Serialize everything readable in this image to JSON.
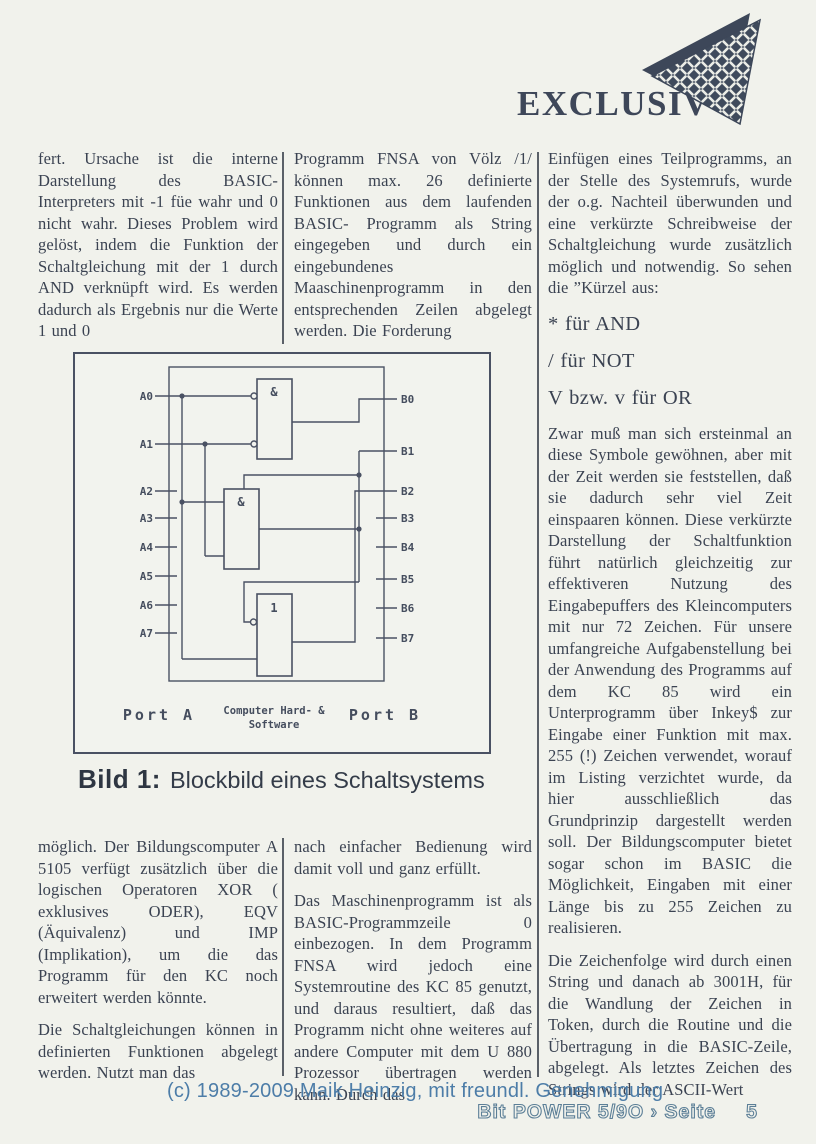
{
  "page": {
    "background": "#f1f2ec",
    "ink": "#3b4352"
  },
  "header": {
    "brand": "EXCLUSIV",
    "logo_icon": "woven-triangle"
  },
  "article": {
    "col1_top": {
      "p1": "fert. Ursache ist die interne Darstellung des BASIC- Interpreters mit -1 füe wahr und 0 nicht wahr. Dieses Problem wird gelöst, indem die Funktion der Schaltgleichung mit der 1 durch AND verknüpft wird. Es werden dadurch als Ergebnis nur die Werte 1 und 0"
    },
    "col2_top": {
      "p1": "Programm FNSA von Völz /1/ können max. 26 definierte Funktionen aus dem laufenden BASIC- Programm als String eingegeben und durch ein eingebundenes Maaschinenprogramm in den entsprechenden Zeilen abgelegt werden. Die Forderung"
    },
    "col3": {
      "p1": "Einfügen eines Teilprogramms, an der Stelle des Systemrufs, wurde der o.g. Nachteil überwunden und eine verkürzte Schreibweise der Schaltgleichung wurde zusätzlich möglich und notwendig. So sehen die ”Kürzel aus:",
      "shortcuts": [
        "* für AND",
        "/ für NOT",
        "V bzw. v für OR"
      ],
      "p2": "Zwar muß man sich ersteinmal an diese Symbole gewöhnen, aber mit der Zeit werden sie feststellen, daß sie dadurch sehr viel Zeit einspaaren können. Diese verkürzte Darstellung der Schaltfunktion führt natürlich gleichzeitig zur effektiveren Nutzung des Eingabepuffers des Kleincomputers mit nur 72 Zeichen. Für unsere umfangreiche Aufgabenstellung bei der Anwendung des Programms auf dem KC 85 wird ein Unterprogramm über Inkey$ zur Eingabe einer Funktion mit max. 255 (!) Zeichen verwendet, worauf im Listing verzichtet wurde, da hier ausschließlich das Grundprinzip dargestellt werden soll. Der Bildungscomputer bietet sogar schon im BASIC die Möglichkeit, Eingaben mit einer Länge bis zu 255 Zeichen zu realisieren.",
      "p3": "Die Zeichenfolge wird durch einen String und danach ab 3001H, für die Wandlung der Zeichen in Token, durch die Routine und die Übertragung in die BASIC-Zeile, abgelegt. Als letztes Zeichen des Strings wird der ASCII-Wert"
    },
    "col1_bottom": {
      "p1": "möglich. Der Bildungscomputer A 5105 verfügt zusätzlich über die logischen Operatoren XOR ( exklusives ODER), EQV (Äquivalenz) und IMP (Implikation), um die das Programm für den KC noch erweitert werden könnte.",
      "p2": "Die Schaltgleichungen können in definierten Funktionen abgelegt werden. Nutzt man das"
    },
    "col2_bottom": {
      "p1": "nach einfacher Bedienung wird damit voll und ganz erfüllt.",
      "p2": "Das Maschinenprogramm ist als BASIC-Programmzeile 0 einbezogen. In dem Programm FNSA wird jedoch eine Systemroutine des KC 85 genutzt, und daraus resultiert, daß das Programm nicht ohne weiteres auf andere Computer mit dem U 880 Prozessor übertragen werden kann. Durch das"
    }
  },
  "figure": {
    "caption_label": "Bild 1:",
    "caption_text": "Blockbild eines Schaltsystems",
    "diagram": {
      "port_a_label": "Port A",
      "port_b_label": "Port B",
      "center_label_line1": "Computer Hard- &",
      "center_label_line2": "Software",
      "gate1_label": "&",
      "gate2_label": "&",
      "gate3_label": "1",
      "port_a_pins": [
        "A0",
        "A1",
        "A2",
        "A3",
        "A4",
        "A5",
        "A6",
        "A7"
      ],
      "port_b_pins": [
        "B0",
        "B1",
        "B2",
        "B3",
        "B4",
        "B5",
        "B6",
        "B7"
      ]
    }
  },
  "footer": {
    "copyright": "(c) 1989-2009 Maik Heinzig, mit freundl. Genehmigung",
    "magazine": "Bit POWER 5/9O › Seite",
    "page_number": "5"
  }
}
